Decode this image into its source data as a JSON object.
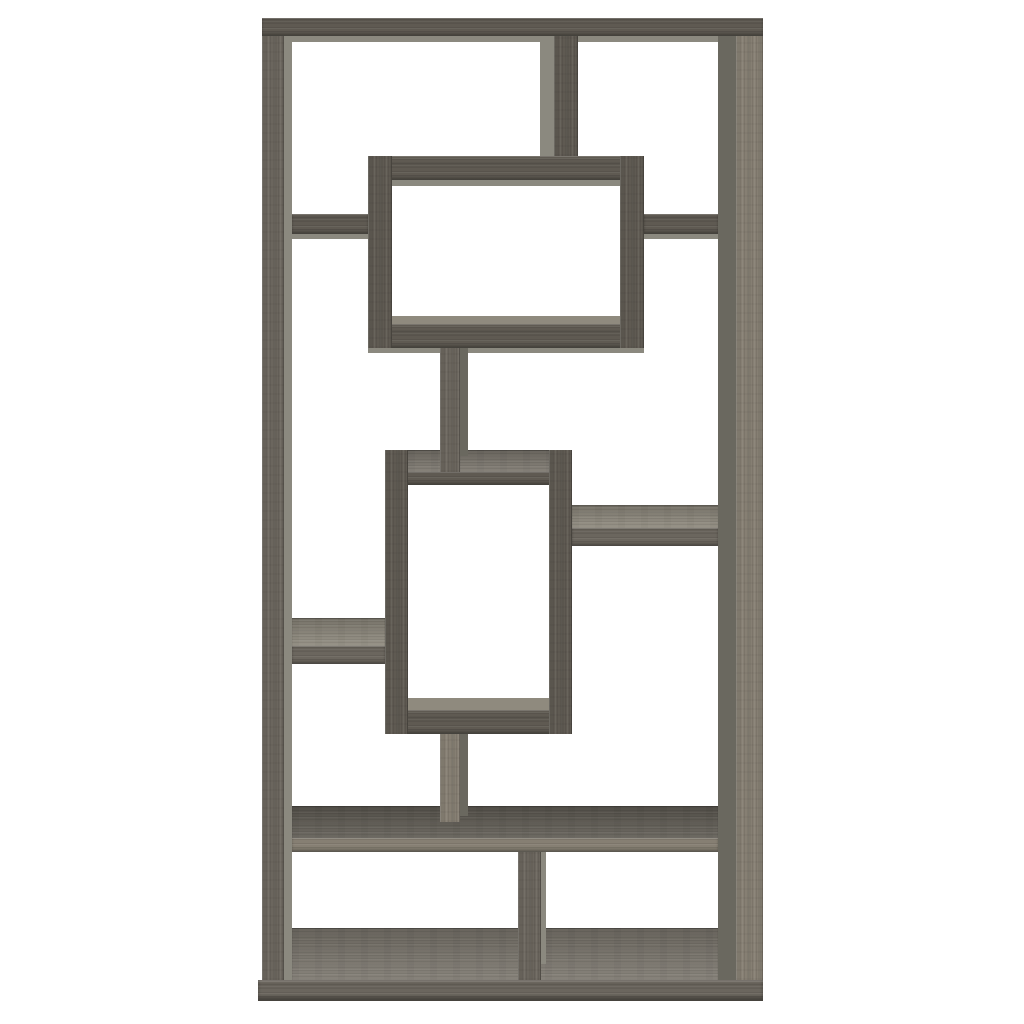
{
  "image": {
    "kind": "product-photo",
    "subject": "tall geometric interlocking-rectangle bookcase with open asymmetric shelves",
    "finish": "weathered grey oak-grain wood",
    "background_color": "#ffffff",
    "visible_text": []
  },
  "palette": {
    "bg": "#ffffff",
    "wood_dark": "#5f5a52",
    "wood_mid": "#6b665e",
    "wood_light": "#867f73",
    "side_light": "#8b897f",
    "side_dark": "#6a685f",
    "surface_light": "#8f8a7e",
    "surface_mid": "#7d786f",
    "surface_dark": "#615d55"
  },
  "bookcase": {
    "outer_box": {
      "x": 258,
      "y": 18,
      "w": 505,
      "h": 983
    },
    "parts": [
      {
        "name": "top-board",
        "type": "h",
        "tone": "wood_dark",
        "x": 262,
        "y": 18,
        "w": 501,
        "h": 18
      },
      {
        "name": "top-board-underside",
        "type": "flat",
        "tone": "side_light",
        "x": 292,
        "y": 36,
        "w": 426,
        "h": 6
      },
      {
        "name": "left-post-front",
        "type": "v",
        "tone": "wood_mid",
        "x": 262,
        "y": 36,
        "w": 22,
        "h": 944
      },
      {
        "name": "left-post-side",
        "type": "flat",
        "tone": "side_light",
        "x": 284,
        "y": 36,
        "w": 8,
        "h": 944
      },
      {
        "name": "right-post-side",
        "type": "flat",
        "tone": "side_dark",
        "x": 718,
        "y": 36,
        "w": 18,
        "h": 944
      },
      {
        "name": "right-post-front",
        "type": "v",
        "tone": "wood_light",
        "x": 736,
        "y": 36,
        "w": 27,
        "h": 944
      },
      {
        "name": "top-divider-side",
        "type": "flat",
        "tone": "side_light",
        "x": 540,
        "y": 36,
        "w": 14,
        "h": 120
      },
      {
        "name": "top-divider-front",
        "type": "v",
        "tone": "wood_dark",
        "x": 554,
        "y": 36,
        "w": 24,
        "h": 120
      },
      {
        "name": "upper-box-top",
        "type": "h",
        "tone": "wood_dark",
        "x": 368,
        "y": 156,
        "w": 276,
        "h": 24
      },
      {
        "name": "upper-box-top-underside",
        "type": "flat",
        "tone": "side_light",
        "x": 392,
        "y": 180,
        "w": 228,
        "h": 6
      },
      {
        "name": "upper-box-bottom-surface",
        "type": "flat",
        "tone": "surface_light",
        "x": 392,
        "y": 316,
        "w": 228,
        "h": 8
      },
      {
        "name": "upper-box-bottom",
        "type": "h",
        "tone": "wood_dark",
        "x": 368,
        "y": 324,
        "w": 276,
        "h": 24
      },
      {
        "name": "upper-box-bottom-underside",
        "type": "flat",
        "tone": "side_light",
        "x": 368,
        "y": 348,
        "w": 276,
        "h": 5
      },
      {
        "name": "upper-box-left",
        "type": "v",
        "tone": "wood_dark",
        "x": 368,
        "y": 156,
        "w": 24,
        "h": 192
      },
      {
        "name": "upper-box-right",
        "type": "v",
        "tone": "wood_dark",
        "x": 620,
        "y": 156,
        "w": 24,
        "h": 192
      },
      {
        "name": "upper-left-shelf",
        "type": "h",
        "tone": "wood_dark",
        "x": 292,
        "y": 214,
        "w": 76,
        "h": 20
      },
      {
        "name": "upper-left-shelf-underside",
        "type": "flat",
        "tone": "side_light",
        "x": 292,
        "y": 234,
        "w": 76,
        "h": 5
      },
      {
        "name": "upper-right-shelf",
        "type": "h",
        "tone": "wood_dark",
        "x": 644,
        "y": 214,
        "w": 74,
        "h": 20
      },
      {
        "name": "upper-right-shelf-underside",
        "type": "flat",
        "tone": "side_light",
        "x": 644,
        "y": 234,
        "w": 74,
        "h": 5
      },
      {
        "name": "middle-box-top-surface",
        "type": "deck",
        "tone": "surface_mid",
        "x": 385,
        "y": 450,
        "w": 187,
        "h": 22
      },
      {
        "name": "upper-stem-side",
        "type": "flat",
        "tone": "side_dark",
        "x": 460,
        "y": 348,
        "w": 8,
        "h": 108
      },
      {
        "name": "upper-stem-front",
        "type": "v",
        "tone": "wood_mid",
        "x": 440,
        "y": 348,
        "w": 20,
        "h": 124
      },
      {
        "name": "middle-box-top-front",
        "type": "h",
        "tone": "wood_dark",
        "x": 385,
        "y": 472,
        "w": 187,
        "h": 13
      },
      {
        "name": "middle-box-bottom-surface",
        "type": "flat",
        "tone": "surface_light",
        "x": 408,
        "y": 698,
        "w": 141,
        "h": 12
      },
      {
        "name": "middle-box-bottom",
        "type": "h",
        "tone": "wood_dark",
        "x": 385,
        "y": 710,
        "w": 187,
        "h": 24
      },
      {
        "name": "middle-box-left",
        "type": "v",
        "tone": "wood_dark",
        "x": 385,
        "y": 450,
        "w": 23,
        "h": 284
      },
      {
        "name": "middle-box-right",
        "type": "v",
        "tone": "wood_dark",
        "x": 549,
        "y": 450,
        "w": 23,
        "h": 284
      },
      {
        "name": "mid-right-shelf-surface",
        "type": "deck",
        "tone": "surface_light",
        "x": 572,
        "y": 505,
        "w": 146,
        "h": 23
      },
      {
        "name": "mid-right-shelf-front",
        "type": "h",
        "tone": "wood_mid",
        "x": 572,
        "y": 528,
        "w": 146,
        "h": 18
      },
      {
        "name": "mid-left-shelf-surface",
        "type": "deck",
        "tone": "surface_light",
        "x": 292,
        "y": 618,
        "w": 93,
        "h": 28
      },
      {
        "name": "mid-left-shelf-front",
        "type": "h",
        "tone": "wood_mid",
        "x": 292,
        "y": 646,
        "w": 93,
        "h": 18
      },
      {
        "name": "lower-shelf-surface",
        "type": "deck",
        "tone": "surface_dark",
        "x": 292,
        "y": 806,
        "w": 426,
        "h": 32
      },
      {
        "name": "lower-stem-side",
        "type": "flat",
        "tone": "side_dark",
        "x": 460,
        "y": 734,
        "w": 8,
        "h": 82
      },
      {
        "name": "lower-stem-front",
        "type": "v",
        "tone": "wood_light",
        "x": 440,
        "y": 734,
        "w": 20,
        "h": 88
      },
      {
        "name": "lower-shelf-front",
        "type": "h",
        "tone": "wood_light",
        "x": 292,
        "y": 838,
        "w": 426,
        "h": 14
      },
      {
        "name": "bottom-deck",
        "type": "deck",
        "tone": "surface_mid",
        "x": 292,
        "y": 928,
        "w": 426,
        "h": 52
      },
      {
        "name": "bottom-divider-front",
        "type": "v",
        "tone": "wood_mid",
        "x": 518,
        "y": 852,
        "w": 23,
        "h": 128
      },
      {
        "name": "bottom-divider-edge",
        "type": "flat",
        "tone": "side_light",
        "x": 541,
        "y": 852,
        "w": 5,
        "h": 112
      },
      {
        "name": "base-board",
        "type": "h base",
        "tone": "wood_mid",
        "x": 258,
        "y": 980,
        "w": 505,
        "h": 21
      }
    ]
  }
}
